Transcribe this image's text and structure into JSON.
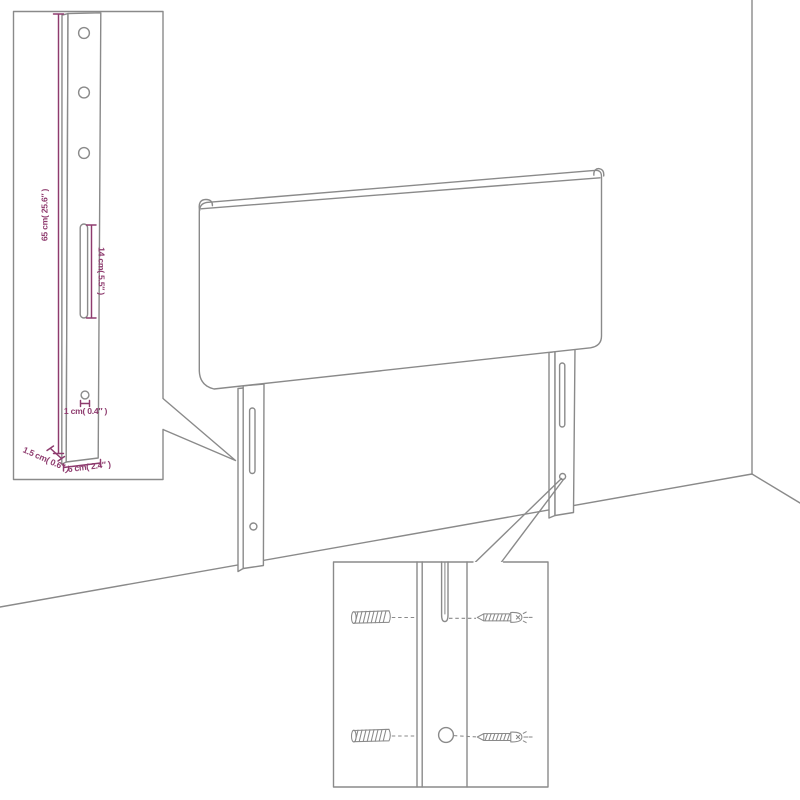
{
  "diagram": {
    "colors": {
      "background": "#ffffff",
      "line": "#8a8a8a",
      "dimension": "#8e3b6e"
    },
    "dimension_labels": {
      "bracket_height": "65 cm( 25.6″ )",
      "slot_length": "14 cm( 5.5″ )",
      "hole_diameter": "1 cm( 0.4″ )",
      "bracket_width": "6 cm( 2.4″ )",
      "bracket_thickness": "1.5 cm( 0.6″ )"
    }
  }
}
